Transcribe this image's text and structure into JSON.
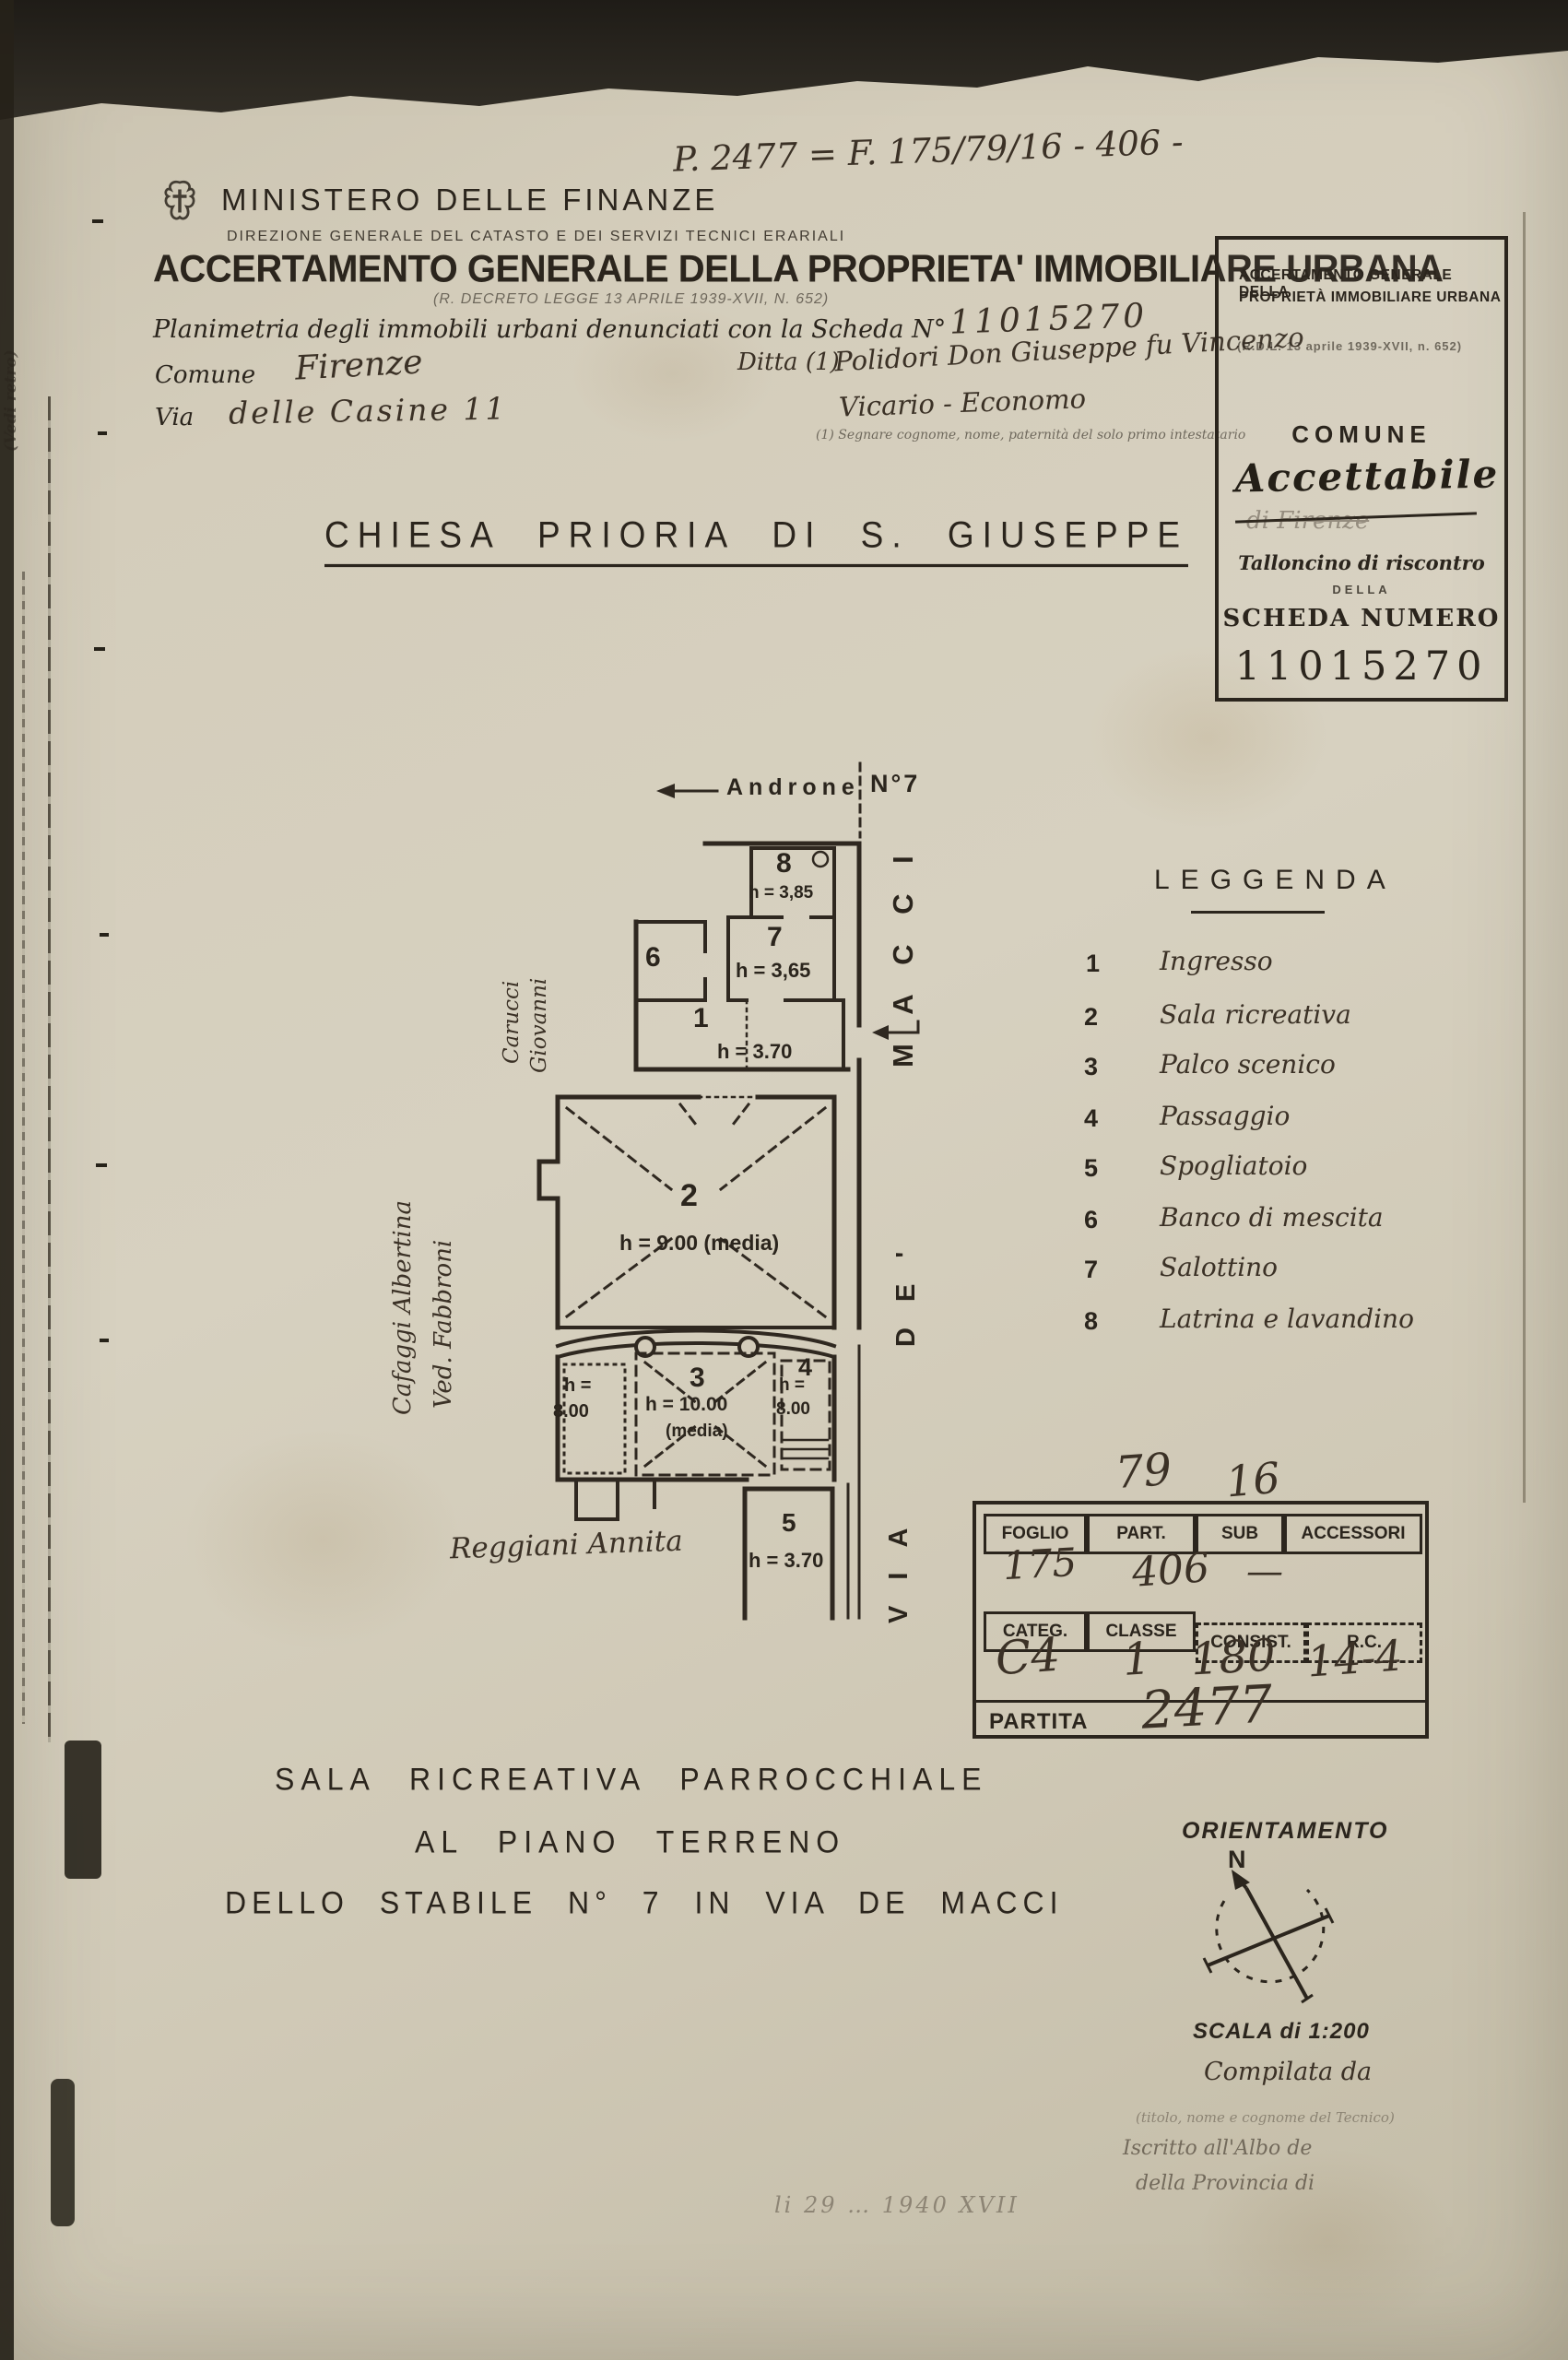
{
  "header": {
    "ministry": "MINISTERO DELLE FINANZE",
    "direction": "DIREZIONE GENERALE DEL CATASTO E DEI SERVIZI TECNICI ERARIALI",
    "title": "ACCERTAMENTO GENERALE DELLA PROPRIETA' IMMOBILIARE URBANA",
    "decree": "(R. DECRETO LEGGE 13 APRILE 1939-XVII, N. 652)",
    "annotation": "P. 2477 = F. 175/79/16 - 406 -"
  },
  "form": {
    "planimetria_label": "Planimetria degli immobili urbani denunciati con la Scheda N°",
    "scheda_number": "11015270",
    "comune_label": "Comune",
    "comune_value": "Firenze",
    "via_label": "Via",
    "via_value": "delle Casine 11",
    "ditta_label": "Ditta (1)",
    "ditta_value1": "Polidori Don Giuseppe fu Vincenzo",
    "ditta_value2": "Vicario - Economo",
    "footnote": "(1) Segnare cognome, nome, paternità del solo primo intestatario"
  },
  "talloncino": {
    "line1": "ACCERTAMENTO GENERALE DELLA",
    "line2": "PROPRIETÀ IMMOBILIARE URBANA",
    "decree": "(R.D.L. 13 aprile 1939-XVII, n. 652)",
    "comune_label": "COMUNE",
    "stamp": "Accettabile",
    "stamp_struck": "di Firenze",
    "talloncino_line": "Talloncino di riscontro",
    "della": "DELLA",
    "scheda_label": "SCHEDA NUMERO",
    "scheda_number": "11015270"
  },
  "doc_title": "CHIESA PRIORIA DI S. GIUSEPPE",
  "plan": {
    "androne": "Androne",
    "civic": "N°7",
    "street": {
      "macci": "M A C C I",
      "de": "D E '",
      "via": "V I A"
    },
    "rooms": {
      "r8": {
        "n": "8",
        "h": "h = 3,85"
      },
      "r7": {
        "n": "7",
        "h": "h = 3,65"
      },
      "r6": {
        "n": "6"
      },
      "r1": {
        "n": "1",
        "h": "h = 3.70"
      },
      "r2": {
        "n": "2",
        "h": "h = 9.00 (media)"
      },
      "r3": {
        "n": "3",
        "h1": "h = 10.00",
        "h2": "(media)"
      },
      "rL": {
        "h1": "h =",
        "h2": "8.00"
      },
      "r4": {
        "n": "4",
        "h1": "h =",
        "h2": "8.00"
      },
      "r5": {
        "n": "5",
        "h": "h = 3.70"
      }
    },
    "neighbors": {
      "top_left1": "Carucci",
      "top_left2": "Giovanni",
      "left1": "Cafaggi Albertina",
      "left2": "Ved. Fabbroni",
      "bottom": "Reggiani Annita"
    }
  },
  "legend": {
    "title": "LEGGENDA",
    "items": [
      {
        "n": "1",
        "label": "Ingresso"
      },
      {
        "n": "2",
        "label": "Sala ricreativa"
      },
      {
        "n": "3",
        "label": "Palco scenico"
      },
      {
        "n": "4",
        "label": "Passaggio"
      },
      {
        "n": "5",
        "label": "Spogliatoio"
      },
      {
        "n": "6",
        "label": "Banco di mescita"
      },
      {
        "n": "7",
        "label": "Salottino"
      },
      {
        "n": "8",
        "label": "Latrina e lavandino"
      }
    ]
  },
  "table": {
    "col_headers_top": [
      "FOGLIO",
      "PART.",
      "SUB",
      "ACCESSORI"
    ],
    "annotation_top_left": "79",
    "annotation_top_right": "16",
    "foglio_value": "175",
    "part_value": "406",
    "sub_value": "—",
    "col_headers_mid": [
      "CATEG.",
      "CLASSE",
      "CONSIST.",
      "R.C."
    ],
    "categ_value": "C4",
    "classe_value": "1",
    "consist_value": "180",
    "rc_value": "14-4",
    "partita_label": "PARTITA",
    "partita_value": "2477"
  },
  "caption": {
    "line1": "SALA RICREATIVA PARROCCHIALE",
    "line2": "AL PIANO TERRENO",
    "line3": "DELLO STABILE N° 7 IN VIA DE MACCI"
  },
  "orientation": {
    "title": "ORIENTAMENTO",
    "north": "N",
    "scale": "SCALA di 1:200",
    "compiled": "Compilata da",
    "tecnico_note": "(titolo, nome e cognome del Tecnico)",
    "albo1": "Iscritto all'Albo de",
    "albo2": "della Provincia di",
    "date": "li 29 … 1940 XVII"
  },
  "margin": {
    "note": "(Vedi retro)"
  }
}
